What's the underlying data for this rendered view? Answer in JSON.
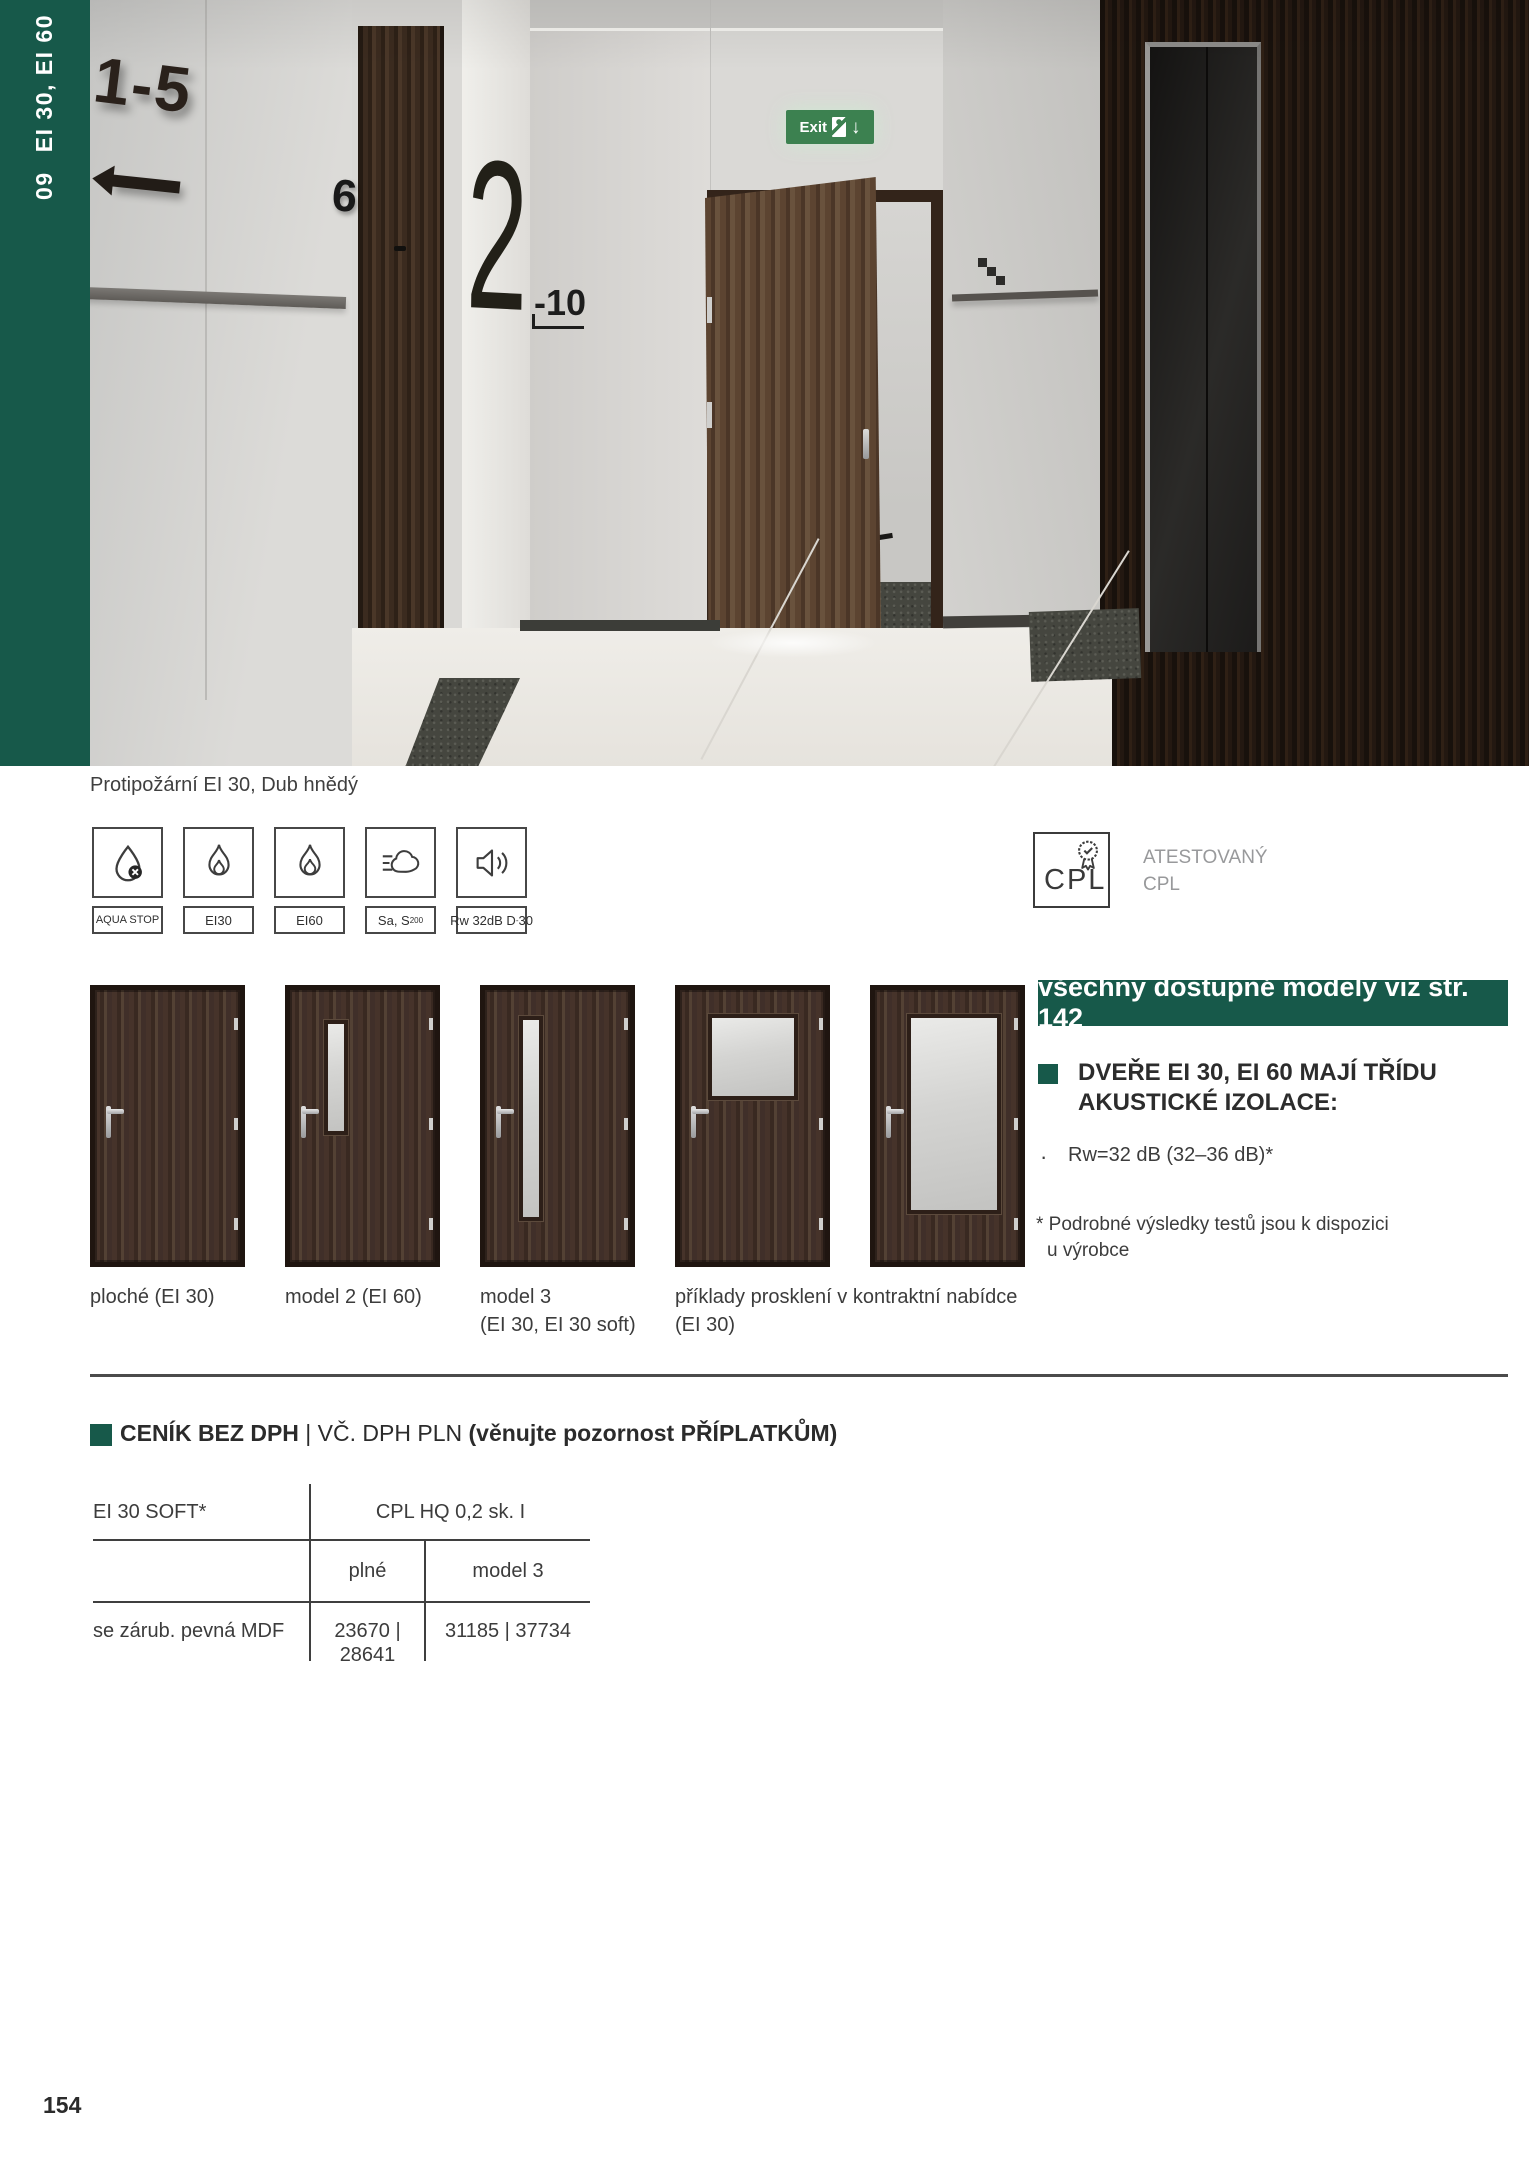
{
  "page": {
    "number": "154",
    "accent_green": "#17594a"
  },
  "sidebar": {
    "chapter": "09",
    "title": "EI 30, EI 60"
  },
  "photo": {
    "caption": "Protipožární EI 30, Dub hnědý",
    "signs": {
      "apartments_range": "1-5",
      "door_number": "6",
      "floor_number": "2",
      "floor_range": "-10",
      "exit_label": "Exit"
    }
  },
  "icon_row": [
    {
      "icon": "aqua-stop-icon",
      "label_main": "AQUA STOP",
      "label_sub": "",
      "label_end": ""
    },
    {
      "icon": "fire-ei30-icon",
      "label_main": "EI30",
      "label_sub": "",
      "label_end": ""
    },
    {
      "icon": "fire-ei60-icon",
      "label_main": "EI60",
      "label_sub": "",
      "label_end": ""
    },
    {
      "icon": "smoke-icon",
      "label_main": "Sa, S",
      "label_sub": "200",
      "label_end": ""
    },
    {
      "icon": "acoustic-icon",
      "label_main": "Rw 32dB D",
      "label_sub": "-",
      "label_end": "30"
    }
  ],
  "certification": {
    "badge_label": "CPL",
    "line1": "ATESTOVANÝ",
    "line2": "CPL"
  },
  "models_banner": {
    "text": "všechny dostupné modely viz str. 142"
  },
  "doors": [
    {
      "label1": "ploché (EI 30)",
      "label2": ""
    },
    {
      "label1": "model 2 (EI 60)",
      "label2": ""
    },
    {
      "label1": "model 3",
      "label2": "(EI 30, EI 30 soft)"
    },
    {
      "label1": "příklady prosklení v kontraktní nabídce",
      "label2": "(EI 30)"
    },
    {
      "label1": "",
      "label2": ""
    }
  ],
  "acoustics": {
    "heading1": "DVEŘE EI 30, EI 60 MAJÍ TŘÍDU",
    "heading2": "AKUSTICKÉ IZOLACE:",
    "bullet_marker": "·",
    "bullet_text": "Rw=32 dB (32–36 dB)*",
    "footnote1": "* Podrobné výsledky testů jsou k dispozici",
    "footnote2": "u výrobce"
  },
  "pricing": {
    "heading": {
      "bold1": "CENÍK BEZ DPH",
      "sep": " | ",
      "regular": "VČ. DPH PLN ",
      "bold2": "(věnujte pozornost PŘÍPLATKŮM)"
    },
    "table": {
      "row_header_left": "EI 30 SOFT*",
      "col_group": "CPL HQ 0,2 sk. I",
      "col1": "plné",
      "col2": "model 3",
      "row_label": "se zárub. pevná MDF",
      "price1": "23670 | 28641",
      "price2": "31185 | 37734"
    }
  }
}
